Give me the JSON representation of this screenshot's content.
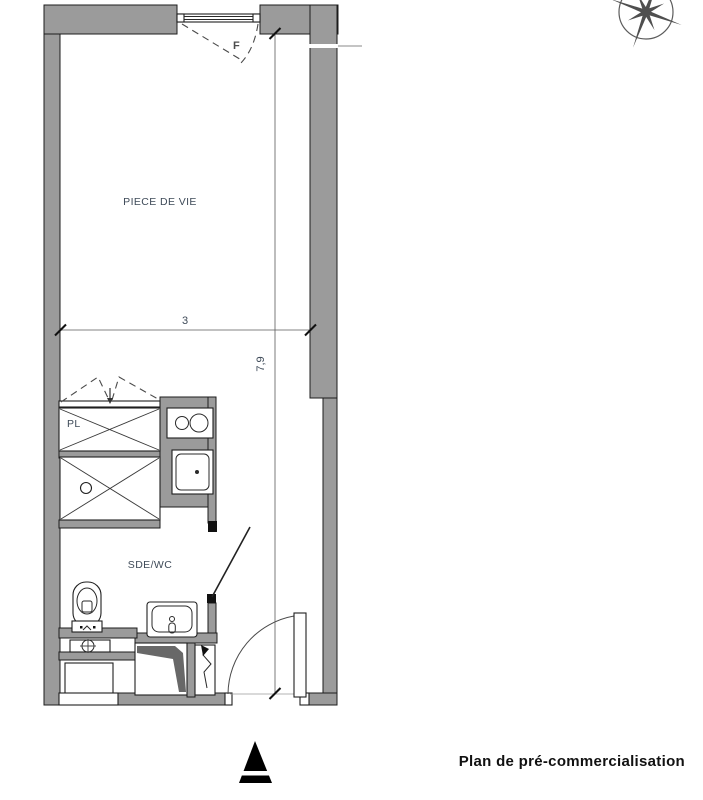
{
  "title": "Plan de pré-commercialisation",
  "labels": {
    "living_room": "PIECE DE VIE",
    "closet": "PL",
    "bathroom": "SDE/WC",
    "window": "F"
  },
  "dimensions": {
    "width": "3",
    "height": "7,9"
  },
  "colors": {
    "wall": "#9b9b9b",
    "shaft": "#686868",
    "compass": "#4f4f4f",
    "label_text": "#3e4a58"
  }
}
